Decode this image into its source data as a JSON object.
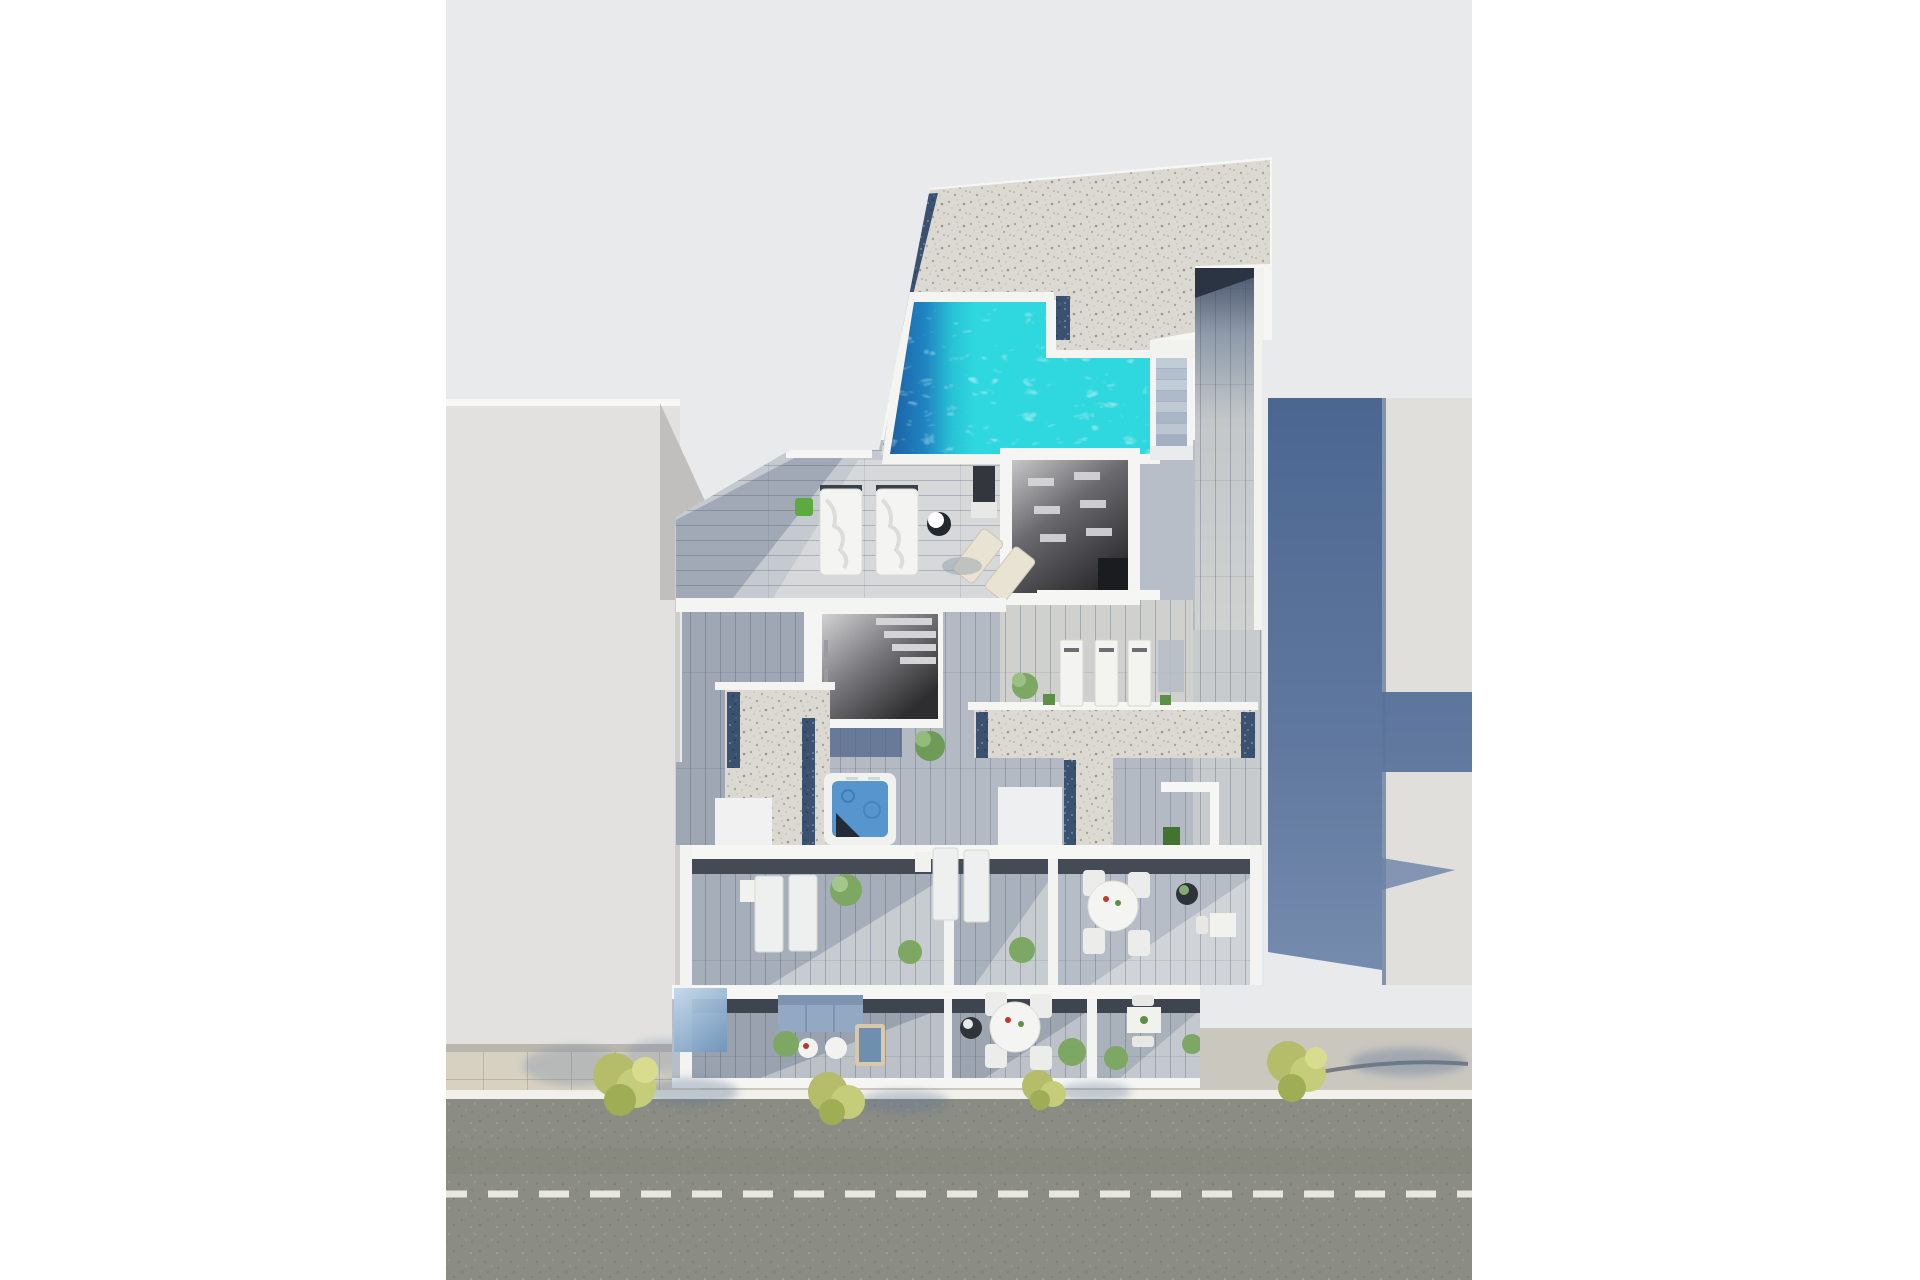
{
  "meta": {
    "render_type": "3d-architectural-render",
    "view": "aerial-top-down",
    "subject": "apartment building with rooftop pool, stacked terraces and street frontage",
    "canvas": {
      "width": 1920,
      "height": 1280,
      "content_left": 446,
      "content_right": 1472
    }
  },
  "colors": {
    "page_bg": "#ffffff",
    "canvas_bg": "#e9eaec",
    "building_white": "#f6f6f4",
    "neighbor_left": "#e2e1df",
    "neighbor_left_wedge": "#c0bfbd",
    "neighbor_right": "#e0dfdc",
    "shadow_blue": "#51698f",
    "gravel_base": "#dcd9d3",
    "navy_tile": "#3a5170",
    "pool_deep": "#1b5fa4",
    "pool_turquoise": "#2fd7de",
    "pool_caustic": "#b6f2ef",
    "wood_base": "#b7bec7",
    "wood_shadow": "#8d97a6",
    "wood_lit": "#d9dbdb",
    "room_dark": "#2b2b2e",
    "corridor_top": "#45536a",
    "asphalt": "#8b8c83",
    "sidewalk": "#cac7bf",
    "paver": "#d7d1c2",
    "curb": "#f1f0ea",
    "lane_marking": "#e8e7df",
    "tree_olive": "#b5bd6a",
    "plant_green": "#5d8f46",
    "jacuzzi_water": "#5795cf",
    "sofa_blue": "#93a8c2",
    "glass_blue": "#8fb4d6"
  },
  "scene": {
    "neighbors": {
      "left_block": {
        "position": "west",
        "roof": "flat light gray",
        "casts_tree_shadows": true
      },
      "right_block": {
        "position": "east",
        "roof": "flat light gray",
        "receives_building_shadow": true
      }
    },
    "main_building": {
      "rooftop": {
        "gravel_roof": true,
        "pool": {
          "shape": "L-shaped",
          "water_colors": [
            "#1b5fa4",
            "#2fd7de"
          ],
          "coping": "white"
        },
        "navy_tile_borders": 2,
        "stairs_steps": 8,
        "corridor": "wood planks, shadowed at top",
        "daybeds_white": 2,
        "wood_loungers": 2,
        "parasol_side_table": 1,
        "grill_dark": 1,
        "plant_pots": 1
      },
      "mid_level": {
        "dark_room_openings": 2,
        "ceiling_vents_visible": true,
        "sunbeds_row": 4,
        "jacuzzi": {
          "count": 1,
          "water": "#5795cf"
        },
        "gravel_patches": [
          "L-shaped west",
          "T-shaped east"
        ],
        "plants": 4,
        "green_cube_planter": 1
      },
      "terrace_row_upper": {
        "patios": 3,
        "loungers": 4,
        "round_dining_table": {
          "tables": 1,
          "chairs": 4
        },
        "small_square_table": 1,
        "dark_planter": 1,
        "side_tables": 2
      },
      "terrace_row_ground": {
        "patios": 3,
        "sofa_blue": 1,
        "coffee_tables": 2,
        "daybed": 1,
        "round_dining_table": {
          "tables": 1,
          "chairs": 4
        },
        "small_square_table": 1,
        "glass_balustrade": true,
        "shrubs": 4
      }
    },
    "street": {
      "road_surface": "asphalt, olive gray",
      "lane_marking_style": "dashed-white",
      "dash_length_px": 30,
      "dash_gap_px": 21,
      "curb": "white line",
      "sidewalk": "concrete with paver strip on west side",
      "trees_count": 4,
      "tree_shadow_direction": "east"
    }
  }
}
